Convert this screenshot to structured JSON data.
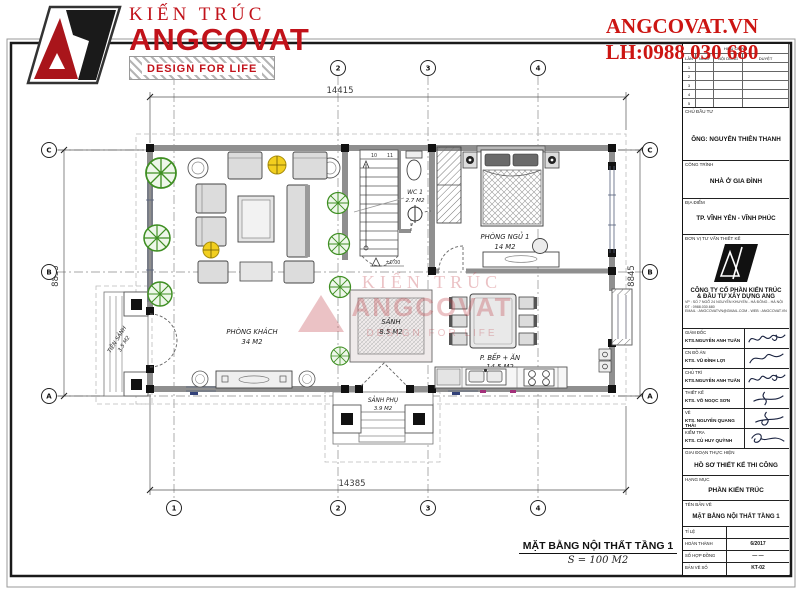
{
  "header": {
    "brand_pre": "KIẾN TRÚC",
    "brand_name": "ANGCOVAT",
    "brand_tagline": "DESIGN FOR LIFE",
    "website": "ANGCOVAT.VN",
    "phone": "LH:0988 030 680",
    "brand_color": "#c1121a"
  },
  "plan": {
    "title": "MẶT BẰNG NỘI THẤT TẦNG 1",
    "scale": "S = 100 M2",
    "level": "±0.00",
    "stair_numbers": [
      "10",
      "11"
    ],
    "dims": {
      "top": "14415",
      "bottom": "14385",
      "left": "8835",
      "right": "8845"
    },
    "grid": {
      "cols": [
        "1",
        "2",
        "3",
        "4"
      ],
      "rows": [
        "C",
        "B",
        "A"
      ]
    },
    "rooms": [
      {
        "name": "PHÒNG KHÁCH",
        "area": "34 M2"
      },
      {
        "name": "SẢNH",
        "area": "8.5 M2"
      },
      {
        "name": "WC 1",
        "area": "2.7 M2"
      },
      {
        "name": "PHÒNG NGỦ 1",
        "area": "14 M2"
      },
      {
        "name": "P. BẾP + ĂN",
        "area": "14.5 M2"
      },
      {
        "name": "TIỀN SẢNH",
        "area": "3.5 M2"
      },
      {
        "name": "SẢNH PHỤ",
        "area": "3.9 M2"
      }
    ],
    "watermark": {
      "line1": "KIẾN TRÚC",
      "line2": "ANGCOVAT",
      "line3": "DESIGN FOR LIFE"
    }
  },
  "titleblock": {
    "revisions": {
      "title": "HIỆU CHỈNH",
      "cols": [
        "LẦN",
        "NGÀY",
        "NỘI DUNG",
        "DUYỆT"
      ],
      "rows": [
        "1",
        "2",
        "3",
        "4",
        "5"
      ]
    },
    "owner": {
      "label": "CHỦ ĐẦU TƯ",
      "value": "ÔNG: NGUYỄN THIÊN THANH"
    },
    "project": {
      "label": "CÔNG TRÌNH",
      "value": "NHÀ Ở GIA ĐÌNH"
    },
    "location": {
      "label": "ĐỊA ĐIỂM",
      "value": "TP. VĨNH YÊN - VĨNH PHÚC"
    },
    "consultant": {
      "label": "ĐƠN VỊ TƯ VẤN THIẾT KẾ",
      "company1": "CÔNG TY CỔ PHẦN KIẾN TRÚC",
      "company2": "& ĐẦU TƯ XÂY DỰNG ANG",
      "addr1": "VP : SỐ 7 NGÕ 24 NGUYỄN KHUYẾN - HÀ ĐÔNG - HÀ NỘI",
      "addr2": "ĐT : 0988.030.680",
      "addr3": "EMAIL : ANGCOVATVN@GMAIL.COM - WEB : ANGCOVAT.VN"
    },
    "signatures": [
      {
        "role": "GIÁM ĐỐC",
        "name": "KTS.NGUYỄN ANH TUẤN"
      },
      {
        "role": "CN ĐỒ ÁN",
        "name": "KTS. VŨ ĐÌNH LỢI"
      },
      {
        "role": "CHỦ TRÌ",
        "name": "KTS.NGUYỄN ANH TUẤN"
      },
      {
        "role": "THIẾT KẾ",
        "name": "KTS. VÕ NGỌC SƠN"
      },
      {
        "role": "VẼ",
        "name": "KTS. NGUYỄN QUANG THÁI"
      },
      {
        "role": "KIỂM TRA",
        "name": "KTS. CÙ HUY QUỲNH"
      }
    ],
    "stage": {
      "label": "GIAI ĐOẠN THỰC HIỆN",
      "value": "HỒ SƠ THIẾT KẾ THI CÔNG"
    },
    "category": {
      "label": "HẠNG MỤC",
      "value": "PHẦN KIẾN TRÚC"
    },
    "drawing": {
      "label": "TÊN BẢN VẼ",
      "value": "MẶT BẰNG NỘI THẤT TẦNG 1"
    },
    "meta": [
      {
        "label": "TỈ LỆ",
        "value": ""
      },
      {
        "label": "HOÀN THÀNH",
        "value": "6/2017"
      },
      {
        "label": "SỐ HỢP ĐỒNG",
        "value": "— —"
      },
      {
        "label": "BẢN VẼ SỐ",
        "value": "KT-02"
      }
    ]
  }
}
